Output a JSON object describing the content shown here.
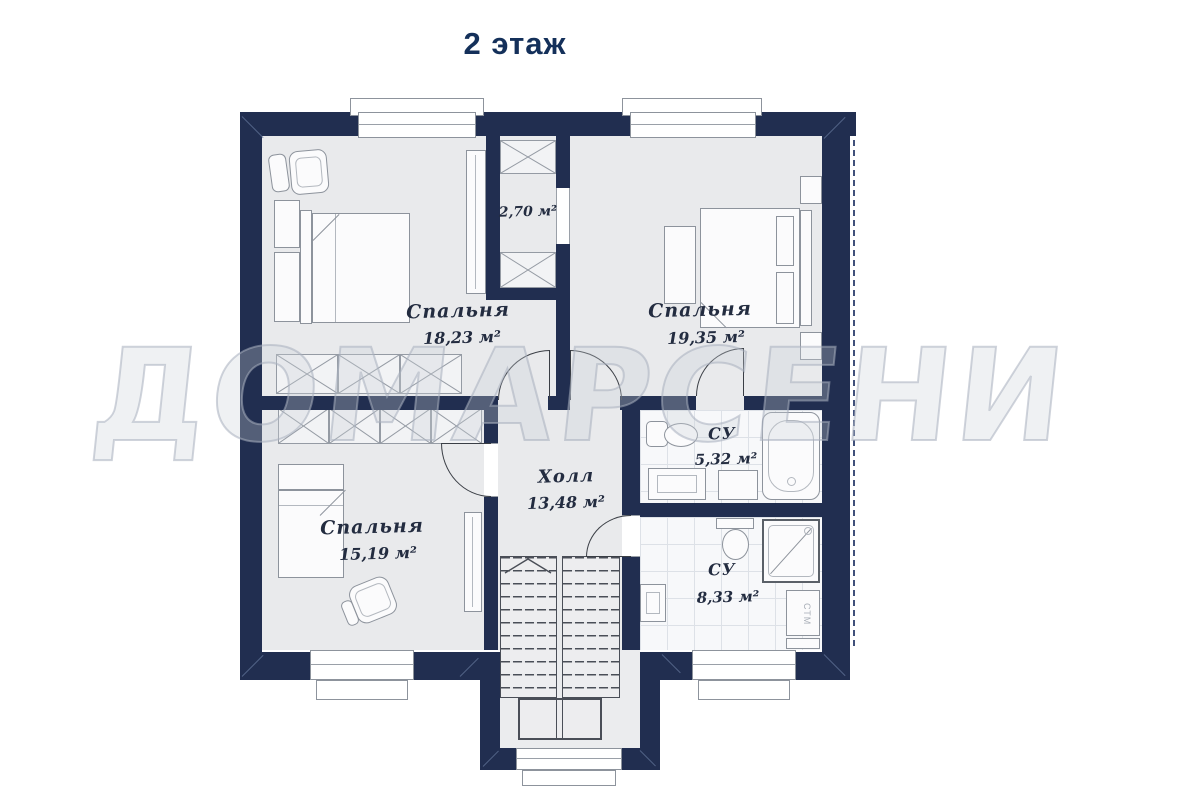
{
  "title": "2 этаж",
  "watermark": "ДОМАРСЕНИ",
  "rooms": [
    {
      "name": "Спальня",
      "area": "18,23 м²"
    },
    {
      "name": "Спальня",
      "area": "19,35 м²"
    },
    {
      "name": "Спальня",
      "area": "15,19 м²"
    },
    {
      "name": "Холл",
      "area": "13,48 м²"
    },
    {
      "name": "",
      "area": "2,70 м²"
    },
    {
      "name": "СУ",
      "area": "5,32 м²"
    },
    {
      "name": "СУ",
      "area": "8,33 м²"
    }
  ],
  "labels": {
    "washer": "СТМ"
  },
  "colors": {
    "wall": "#212e50",
    "title_text": "#14305a",
    "floor": "#e9eaec"
  }
}
